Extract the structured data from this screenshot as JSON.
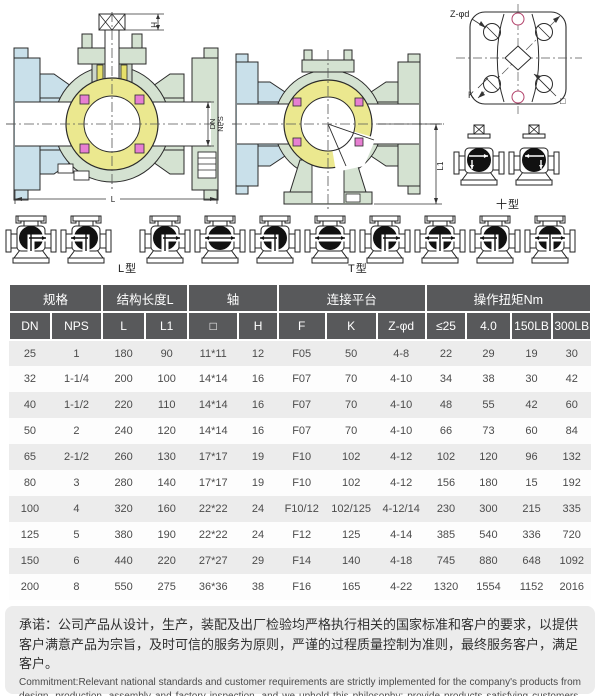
{
  "drawings": {
    "front_view": {
      "labels": {
        "h": "H",
        "dn": "DN",
        "nps": "NPS",
        "l": "L"
      }
    },
    "side_view": {
      "labels": {
        "l1": "L1"
      }
    },
    "flange_view": {
      "labels": {
        "z_d": "Z-φd",
        "k": "K",
        "square": "□"
      }
    },
    "cross_type": {
      "label": "十型",
      "symbols": [
        {
          "flow": "right-down"
        },
        {
          "flow": "left-down"
        }
      ]
    },
    "l_type": {
      "label": "L型",
      "symbols": [
        {
          "flow": "up-right"
        },
        {
          "flow": "up-left"
        }
      ]
    },
    "t_type": {
      "label": "T型",
      "symbols": [
        {
          "flow": "up-right"
        },
        {
          "flow": "left-right"
        },
        {
          "flow": "up-left"
        },
        {
          "flow": "left-right"
        },
        {
          "flow": "up-right"
        },
        {
          "flow": "up-left-right"
        },
        {
          "flow": "up-left"
        },
        {
          "flow": "up-left-right"
        }
      ]
    }
  },
  "table": {
    "groups": [
      {
        "label": "规格",
        "span": 2
      },
      {
        "label": "结构长度L",
        "span": 2
      },
      {
        "label": "轴",
        "span": 2
      },
      {
        "label": "连接平台",
        "span": 3
      },
      {
        "label": "操作扭矩Nm",
        "span": 4
      }
    ],
    "columns": [
      "DN",
      "NPS",
      "L",
      "L1",
      "□",
      "H",
      "F",
      "K",
      "Z-φd",
      "≤25",
      "4.0",
      "150LB",
      "300LB"
    ],
    "rows": [
      [
        "25",
        "1",
        "180",
        "90",
        "11*11",
        "12",
        "F05",
        "50",
        "4-8",
        "22",
        "29",
        "19",
        "30"
      ],
      [
        "32",
        "1-1/4",
        "200",
        "100",
        "14*14",
        "16",
        "F07",
        "70",
        "4-10",
        "34",
        "38",
        "30",
        "42"
      ],
      [
        "40",
        "1-1/2",
        "220",
        "110",
        "14*14",
        "16",
        "F07",
        "70",
        "4-10",
        "48",
        "55",
        "42",
        "60"
      ],
      [
        "50",
        "2",
        "240",
        "120",
        "14*14",
        "16",
        "F07",
        "70",
        "4-10",
        "66",
        "73",
        "60",
        "84"
      ],
      [
        "65",
        "2-1/2",
        "260",
        "130",
        "17*17",
        "19",
        "F10",
        "102",
        "4-12",
        "102",
        "120",
        "96",
        "132"
      ],
      [
        "80",
        "3",
        "280",
        "140",
        "17*17",
        "19",
        "F10",
        "102",
        "4-12",
        "156",
        "180",
        "15",
        "192"
      ],
      [
        "100",
        "4",
        "320",
        "160",
        "22*22",
        "24",
        "F10/12",
        "102/125",
        "4-12/14",
        "230",
        "300",
        "215",
        "335"
      ],
      [
        "125",
        "5",
        "380",
        "190",
        "22*22",
        "24",
        "F12",
        "125",
        "4-14",
        "385",
        "540",
        "336",
        "720"
      ],
      [
        "150",
        "6",
        "440",
        "220",
        "27*27",
        "29",
        "F14",
        "140",
        "4-18",
        "745",
        "880",
        "648",
        "1092"
      ],
      [
        "200",
        "8",
        "550",
        "275",
        "36*36",
        "38",
        "F16",
        "165",
        "4-22",
        "1320",
        "1554",
        "1152",
        "2016"
      ]
    ]
  },
  "commitment": {
    "cn": "承诺：公司产品从设计，生产，装配及出厂检验均严格执行相关的国家标准和客户的要求，以提供客户满意产品为宗旨，及时可信的服务为原则，严谨的过程质量控制为准则，最终服务客户，满足客户。",
    "en": "Commitment:Relevant national standards and customer requirements are strictly implemented for the company's products from design, production, assembly and factory inspection, and we uphold this philosophy: provide products satisfying customers, this principle: timely and credible services, and this rule: strict process quality control, to serve and satisfy customers finally."
  },
  "colors": {
    "header_bg": "#58595b",
    "stripe_bg": "#ececec",
    "ball_yellow": "#ebe88f",
    "body_green": "#d4e2d1",
    "flange_blue": "#c9e0ea",
    "seal_pink": "#e77fd2"
  }
}
